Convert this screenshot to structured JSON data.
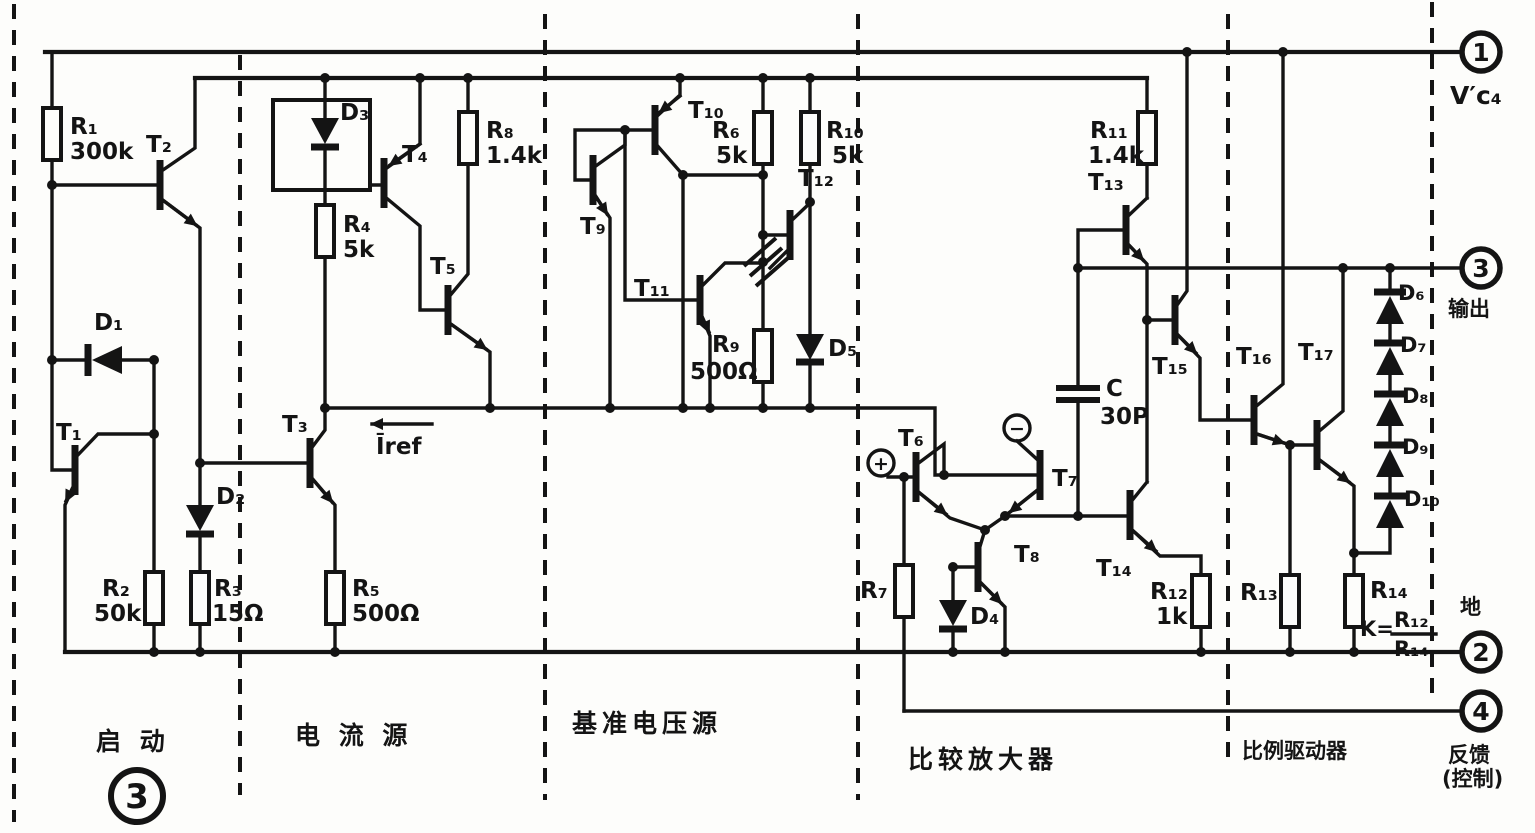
{
  "figure": {
    "number": "3"
  },
  "terminals": {
    "pin1": {
      "number": "1",
      "label": "V′c₄"
    },
    "pin3": {
      "number": "3",
      "label": "输出"
    },
    "pin2": {
      "number": "2",
      "label": "地"
    },
    "pin4": {
      "number": "4",
      "label": "反馈",
      "sublabel": "(控制)"
    }
  },
  "sections": {
    "startup": "启  动",
    "current_source": "电 流 源",
    "voltage_reference": "基准电压源",
    "comparator_amplifier": "比较放大器",
    "proportional_driver": "比例驱动器"
  },
  "resistors": {
    "R1": {
      "name": "R₁",
      "value": "300k"
    },
    "R2": {
      "name": "R₂",
      "value": "50k"
    },
    "R3": {
      "name": "R₃",
      "value": "15Ω"
    },
    "R4": {
      "name": "R₄",
      "value": "5k"
    },
    "R5": {
      "name": "R₅",
      "value": "500Ω"
    },
    "R6": {
      "name": "R₆",
      "value": "5k"
    },
    "R7": {
      "name": "R₇"
    },
    "R8": {
      "name": "R₈",
      "value": "1.4k"
    },
    "R9": {
      "name": "R₉",
      "value": "500Ω"
    },
    "R10": {
      "name": "R₁₀",
      "value": "5k"
    },
    "R11": {
      "name": "R₁₁",
      "value": "1.4k"
    },
    "R12": {
      "name": "R₁₂",
      "value": "1k"
    },
    "R13": {
      "name": "R₁₃"
    },
    "R14": {
      "name": "R₁₄"
    }
  },
  "transistors": {
    "T1": {
      "name": "T₁"
    },
    "T2": {
      "name": "T₂"
    },
    "T3": {
      "name": "T₃"
    },
    "T4": {
      "name": "T₄"
    },
    "T5": {
      "name": "T₅"
    },
    "T6": {
      "name": "T₆"
    },
    "T7": {
      "name": "T₇"
    },
    "T8": {
      "name": "T₈"
    },
    "T9": {
      "name": "T₉"
    },
    "T10": {
      "name": "T₁₀"
    },
    "T11": {
      "name": "T₁₁"
    },
    "T12": {
      "name": "T₁₂"
    },
    "T13": {
      "name": "T₁₃"
    },
    "T14": {
      "name": "T₁₄"
    },
    "T15": {
      "name": "T₁₅"
    },
    "T16": {
      "name": "T₁₆"
    },
    "T17": {
      "name": "T₁₇"
    }
  },
  "diodes": {
    "D1": {
      "name": "D₁"
    },
    "D2": {
      "name": "D₂"
    },
    "D3": {
      "name": "D₃"
    },
    "D4": {
      "name": "D₄"
    },
    "D5": {
      "name": "D₅"
    },
    "D6": {
      "name": "D₆"
    },
    "D7": {
      "name": "D₇"
    },
    "D8": {
      "name": "D₈"
    },
    "D9": {
      "name": "D₉"
    },
    "D10": {
      "name": "D₁₀"
    }
  },
  "capacitor": {
    "name": "C",
    "value": "30P"
  },
  "annotations": {
    "iref": "Īref",
    "plus": "+",
    "minus": "−",
    "k_eq": "K=",
    "k_num": "R₁₂",
    "k_den": "R₁₄"
  }
}
